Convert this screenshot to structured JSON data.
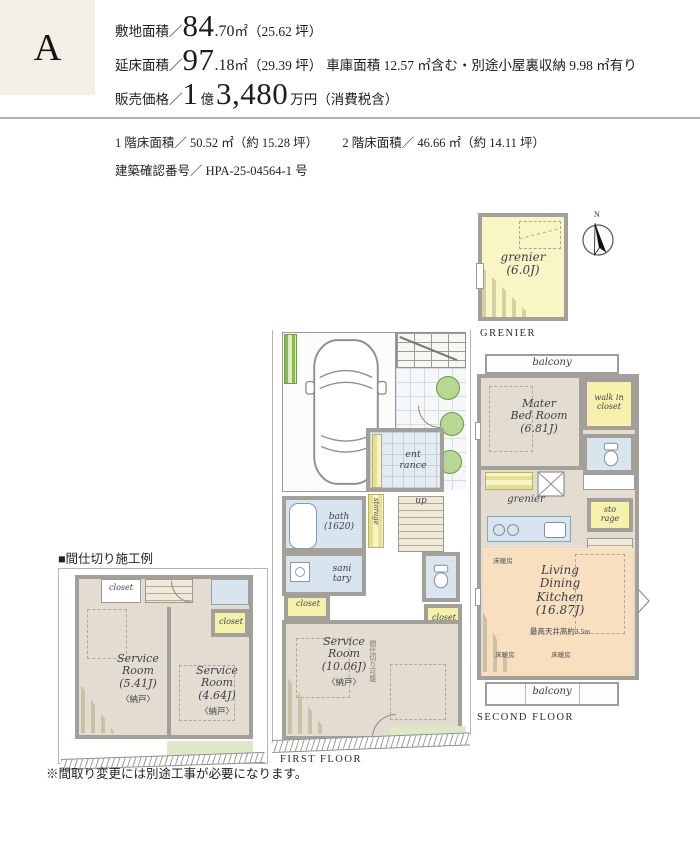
{
  "colors": {
    "header_box": "#f2efe6",
    "wall_gray": "#a3a099",
    "room_beige": "#e3ddd1",
    "room_yellow": "#f6f0ad",
    "room_blue": "#d9e5ee",
    "room_peach": "#f7dfc0",
    "green": "#86b95e"
  },
  "header": {
    "plan_label": "A",
    "site": {
      "label": "敷地面積／",
      "int": "84",
      "dec": ".70",
      "unit": " ㎡",
      "paren": "（25.62 坪）"
    },
    "floor": {
      "label": "延床面積／",
      "int": "97",
      "dec": ".18",
      "unit": " ㎡",
      "paren": "（29.39 坪）",
      "note": "車庫面積 12.57 ㎡含む・別途小屋裏収納 9.98 ㎡有り"
    },
    "price": {
      "label": "販売価格／",
      "num1": "1",
      "unit1": "億",
      "num2": "3,480",
      "unit2": "万円",
      "paren": "（消費税含）"
    }
  },
  "subheader": {
    "floor1": "1 階床面積／ 50.52 ㎡（約 15.28 坪）",
    "floor2": "2 階床面積／ 46.66 ㎡（約 14.11 坪）",
    "confirmation": "建築確認番号／ HPA-25-04564-1 号"
  },
  "grenier_plan": {
    "room": "grenier\n(6.0J)",
    "caption": "GRENIER",
    "compass_n": "N"
  },
  "first_floor": {
    "caption": "FIRST FLOOR",
    "entrance": "ent\nrance",
    "up": "up",
    "storage": "storage",
    "bath": "bath\n(1620)",
    "sanitary": "sani\ntary",
    "closet_left": "closet",
    "closet_right": "closet",
    "service_room": "Service\nRoom\n(10.06J)",
    "service_room_sub": "〈納戸〉",
    "partitionable": "間仕切り可能"
  },
  "second_floor": {
    "caption": "SECOND FLOOR",
    "balcony_top": "balcony",
    "balcony_bottom": "balcony",
    "master_bedroom": "Mater\nBed Room\n(6.81J)",
    "walk_in_closet": "walk in\ncloset",
    "grenier": "grenier",
    "storage": "sto\nrage",
    "down": "dn",
    "ldk": "Living\nDining\nKitchen\n(16.87J)",
    "ceiling_note": "最高天井高約3.5m",
    "floor_heating": "床暖房"
  },
  "partition_plan": {
    "title": "■間仕切り施工例",
    "closet_top": "closet",
    "closet_right": "closet",
    "room_left": "Service\nRoom\n(5.41J)",
    "room_left_sub": "〈納戸〉",
    "room_right": "Service\nRoom\n(4.64J)",
    "room_right_sub": "〈納戸〉",
    "note": "※間取り変更には別途工事が必要になります。"
  }
}
